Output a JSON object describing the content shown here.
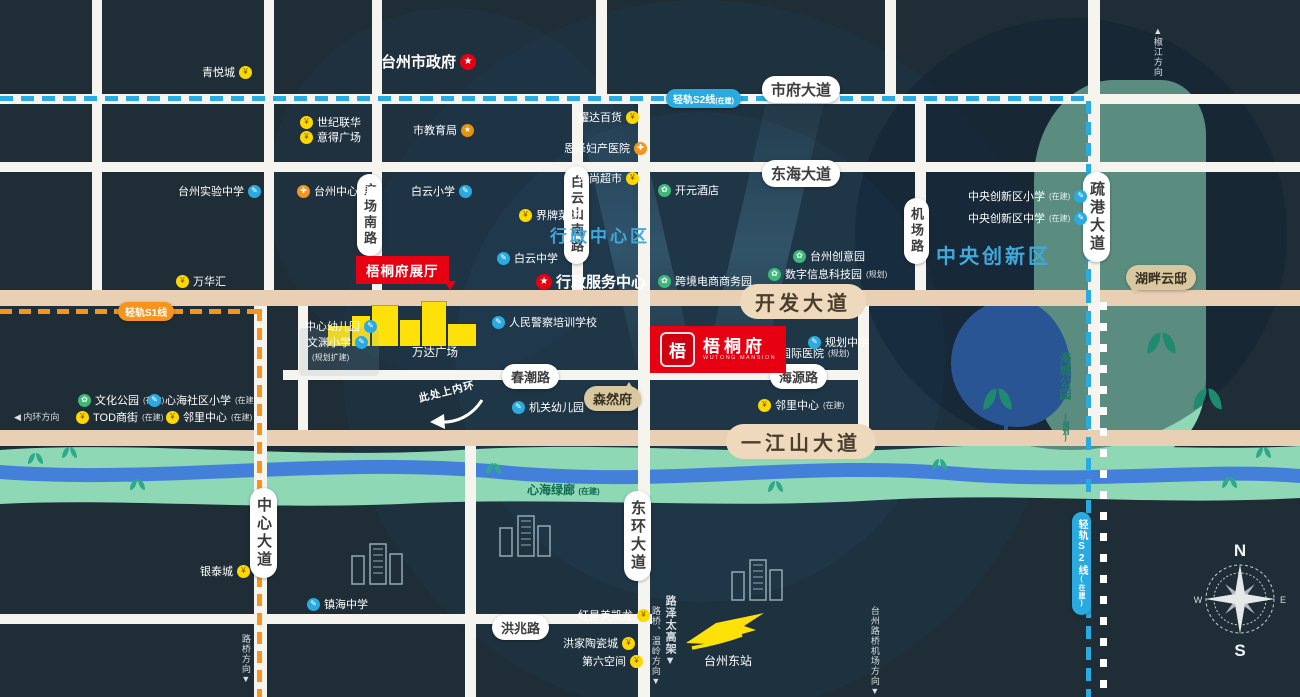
{
  "compass": {
    "n": "N",
    "e": "E",
    "s": "S",
    "w": "W"
  },
  "icons": {
    "mall": "¥",
    "school": "✎",
    "hospital": "✚",
    "gov": "★",
    "park": "✿",
    "edu": "★"
  },
  "roads": {
    "shifu": "市府大道",
    "donghai": "东海大道",
    "kaifa": "开发大道",
    "yijiangshan": "一江山大道",
    "chunchao": "春潮路",
    "haiyuan": "海源路",
    "hongzhao": "洪兆路",
    "guangchangnan": "广场南路",
    "baiyunshannan": "白云山南路",
    "jichang": "机场路",
    "shugang": "疏港大道",
    "zhongxin": "中心大道",
    "donghuan": "东环大道"
  },
  "transit": {
    "s1": "轻轨S1线",
    "s2": "轻轨S2线",
    "s2_status": "(在建)",
    "s2v": "轻轨S2线",
    "s2v_status": "(在建)"
  },
  "areas": {
    "admin": "行政中心区",
    "innovation": "中央创新区",
    "greenway": "心海绿廊",
    "greenway_status": "(在建)",
    "haicheng": "海城公园",
    "haicheng_status": "(规划)"
  },
  "project": {
    "name": "梧桐府",
    "en": "WUTONG MANSION",
    "seal": "梧",
    "showroom": "梧桐府展厅",
    "senranfu": "森然府",
    "hupanyundi": "湖畔云邸"
  },
  "landmarks": {
    "city_gov": "台州市政府",
    "admin_service": "行政服务中心",
    "wanda": "万达广场",
    "station": "台州东站"
  },
  "directions": {
    "north": "▲椒江方向",
    "inner_ring": "◀ 内环方向",
    "ring_up": "此处上内环",
    "luqiao": "路桥方向▼",
    "luqiao_wenling": "路桥、温岭方向▼",
    "luzetai": "路泽太高架▼",
    "airport": "台州路桥机场方向▼"
  },
  "pois": [
    {
      "label": "青悦城",
      "type": "mall"
    },
    {
      "label": "世纪联华",
      "type": "mall"
    },
    {
      "label": "意得广场",
      "type": "mall"
    },
    {
      "label": "市教育局",
      "type": "edu"
    },
    {
      "label": "耀达百货",
      "type": "mall"
    },
    {
      "label": "恩泽妇产医院",
      "type": "hospital"
    },
    {
      "label": "欧尚超市",
      "type": "mall"
    },
    {
      "label": "台州实验中学",
      "type": "school"
    },
    {
      "label": "台州中心医院",
      "type": "hospital"
    },
    {
      "label": "白云小学",
      "type": "school"
    },
    {
      "label": "界牌菜场",
      "type": "mall"
    },
    {
      "label": "白云中学",
      "type": "school"
    },
    {
      "label": "开元酒店",
      "type": "park"
    },
    {
      "label": "跨境电商商务园",
      "type": "park"
    },
    {
      "label": "数字信息科技园",
      "status": "(规划)",
      "type": "park"
    },
    {
      "label": "台州创意园",
      "type": "park"
    },
    {
      "label": "中央创新区小学",
      "status": "(在建)",
      "type": "school"
    },
    {
      "label": "中央创新区中学",
      "status": "(在建)",
      "type": "school"
    },
    {
      "label": "万华汇",
      "type": "mall"
    },
    {
      "label": "中心幼儿园",
      "type": "school"
    },
    {
      "label": "文渊小学",
      "status": "(规划扩建)",
      "type": "school"
    },
    {
      "label": "人民警察培训学校",
      "type": "school"
    },
    {
      "label": "机关幼儿园",
      "type": "school"
    },
    {
      "label": "国际医院",
      "status": "(规划)",
      "type": "hospital"
    },
    {
      "label": "规划中学",
      "type": "school"
    },
    {
      "label": "邻里中心",
      "status": "(在建)",
      "type": "mall"
    },
    {
      "label": "文化公园",
      "status": "(在建)",
      "type": "park"
    },
    {
      "label": "心海社区小学",
      "status": "(在建)",
      "type": "school"
    },
    {
      "label": "TOD商街",
      "status": "(在建)",
      "type": "mall"
    },
    {
      "label": "邻里中心",
      "status": "(在建)",
      "type": "mall"
    },
    {
      "label": "银泰城",
      "type": "mall"
    },
    {
      "label": "镇海中学",
      "type": "school"
    },
    {
      "label": "红星美凯龙",
      "type": "mall"
    },
    {
      "label": "洪家陶瓷城",
      "type": "mall"
    },
    {
      "label": "第六空间",
      "type": "mall"
    }
  ]
}
